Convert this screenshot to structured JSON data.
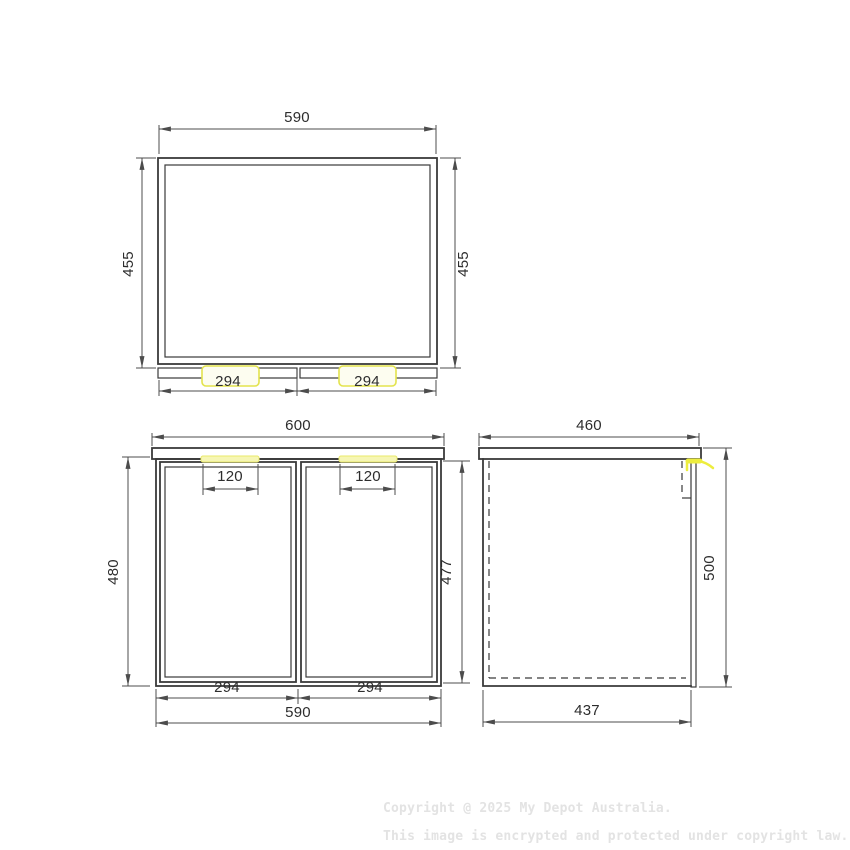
{
  "drawing": {
    "product": "two-door cabinet technical drawing, three orthographic views",
    "units": "mm",
    "views": {
      "top": {
        "width": "590",
        "depth_left": "455",
        "depth_right": "455",
        "door_left_width": "294",
        "door_right_width": "294"
      },
      "front": {
        "top_width": "600",
        "height_left": "480",
        "height_right": "477",
        "handle_left_width": "120",
        "handle_right_width": "120",
        "door_left_width": "294",
        "door_right_width": "294",
        "bottom_width": "590"
      },
      "side": {
        "top_depth": "460",
        "height_right": "500",
        "bottom_depth": "437"
      }
    },
    "colors": {
      "object_line": "#3a3a3a",
      "dimension_line": "#4c4c4c",
      "dimension_text": "#2d2d2d",
      "handle_highlight_stroke": "#e3e34d",
      "handle_highlight_fill": "#f6f6b4",
      "watermark_text": "#e3e3e3",
      "background": "#ffffff"
    }
  },
  "watermark": {
    "line1": "Copyright @ 2025 My Depot Australia.",
    "line2": "This image is encrypted and protected under copyright law."
  }
}
